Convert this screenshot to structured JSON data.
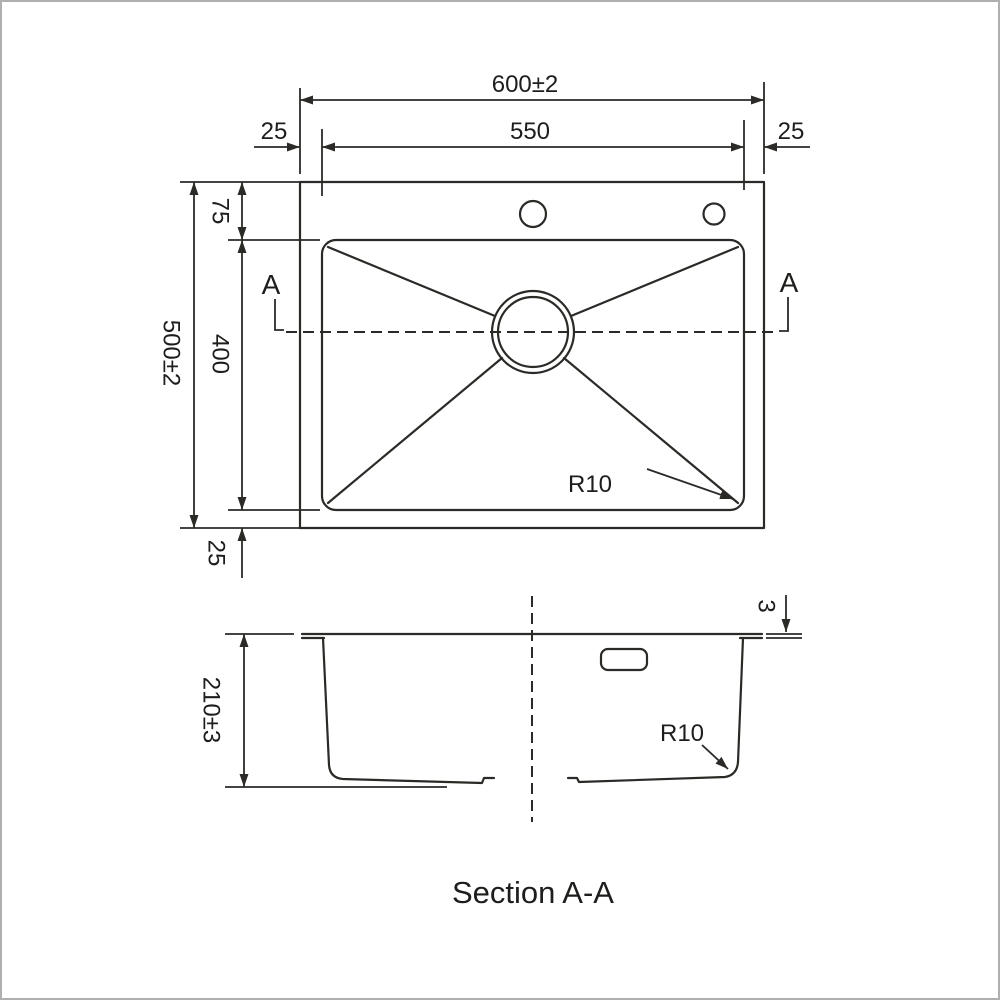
{
  "drawing": {
    "line_color": "#2b2a27",
    "background": "#ffffff",
    "border_color": "#b0b0b0"
  },
  "top_view": {
    "overall_width": "600±2",
    "basin_width": "550",
    "left_margin": "25",
    "right_margin": "25",
    "top_margin": "75",
    "overall_height": "500±2",
    "basin_height": "400",
    "bottom_margin": "25",
    "corner_radius": "R10",
    "section_marker": "A"
  },
  "section_view": {
    "depth": "210±3",
    "rim_thickness": "3",
    "corner_radius": "R10",
    "caption": "Section A-A"
  }
}
